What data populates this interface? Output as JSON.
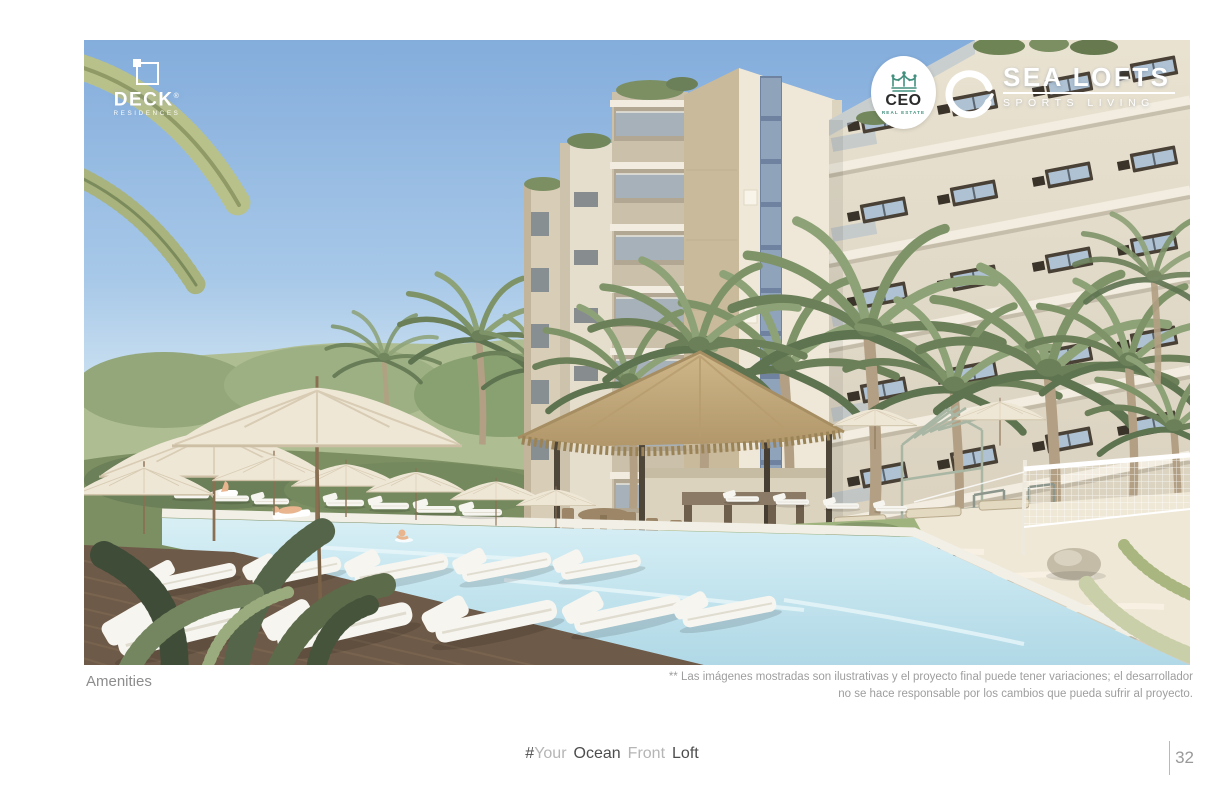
{
  "brand": {
    "deck": {
      "name": "DECK",
      "registered": "®",
      "subtitle": "RESIDENCES"
    },
    "ceo": {
      "name": "CEO",
      "subtitle": "REAL ESTATE",
      "accent": "#43907F"
    },
    "sea_lofts": {
      "name": "SEA LOFTS",
      "subtitle": "SPORTS LIVING"
    }
  },
  "caption": {
    "label": "Amenities"
  },
  "disclaimer": {
    "line1": "** Las imágenes mostradas son ilustrativas y el proyecto final puede tener variaciones; el desarrollador",
    "line2": "no se hace responsable por los cambios que pueda sufrir al proyecto."
  },
  "footer": {
    "segments": [
      {
        "text": "#"
      },
      {
        "text": "Your"
      },
      {
        "text": "Ocean"
      },
      {
        "text": "Front"
      },
      {
        "text": "Loft"
      }
    ],
    "page_number": "32"
  },
  "palette": {
    "sky_top": "#84ADDC",
    "sky_horizon": "#EDF5F8",
    "facade_cream": "#EFE8D8",
    "facade_tan": "#C9BA9C",
    "thatch": "#C3A97C",
    "pool_water": "#C3E4EE",
    "deck_wood": "#6E5A48",
    "foliage_dark": "#4C5A40",
    "foliage_light": "#8EA277",
    "lounger_white": "#F6F5F0",
    "text_dark": "#4D4D4D",
    "text_light": "#B5B5B5",
    "text_gray": "#8D8D8D"
  }
}
